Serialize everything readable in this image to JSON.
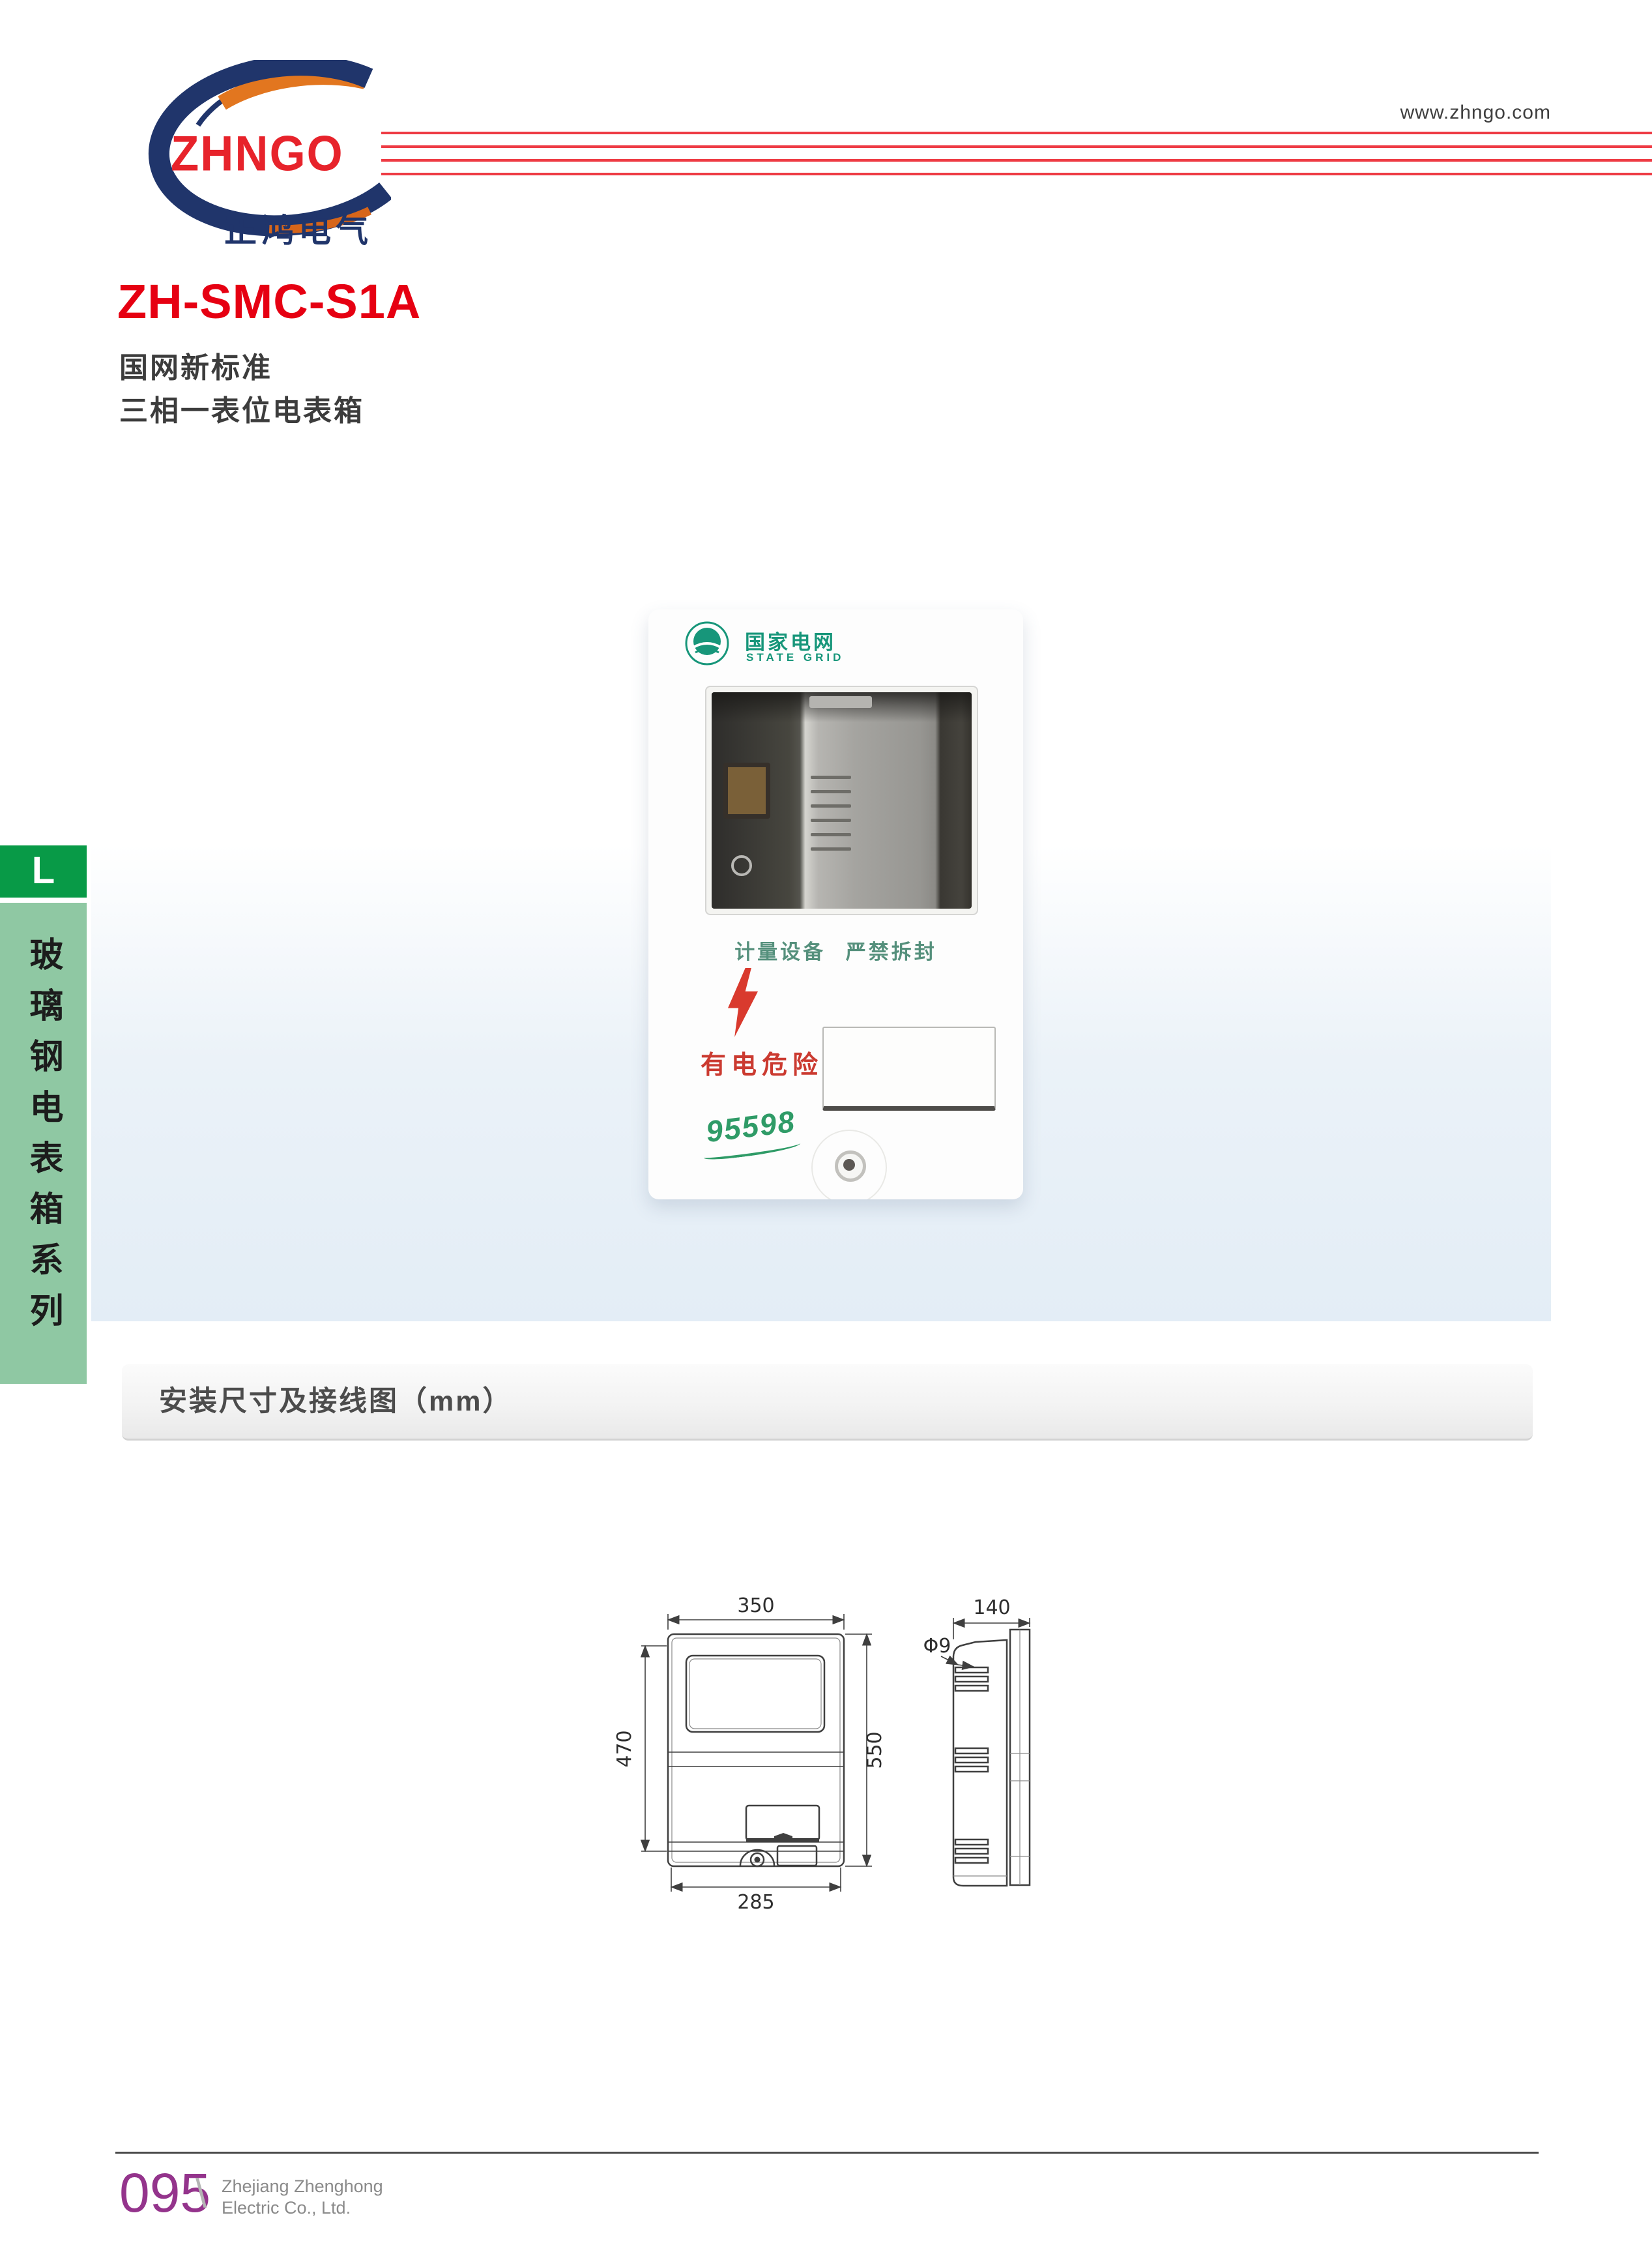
{
  "header": {
    "website": "www.zhngo.com",
    "brand": "ZHNGO",
    "brand_cn": "正鸿电气"
  },
  "product": {
    "model": "ZH-SMC-S1A",
    "standard": "国网新标准",
    "type": "三相一表位电表箱"
  },
  "sidebar": {
    "index_letter": "L",
    "series": "玻璃钢电表箱系列"
  },
  "photo": {
    "emblem_cn": "国家电网",
    "emblem_en": "STATE GRID",
    "caption": "计量设备 严禁拆封",
    "danger": "有电危险",
    "hotline": "95598"
  },
  "section": {
    "title": "安装尺寸及接线图（mm）"
  },
  "drawings": {
    "front": {
      "top": "350",
      "left": "470",
      "right": "550",
      "bottom": "285"
    },
    "side": {
      "top": "140",
      "hole": "Φ9"
    }
  },
  "footer": {
    "page": "095",
    "separator": "\\",
    "company1": "Zhejiang Zhenghong",
    "company2": "Electric Co., Ltd."
  },
  "colors": {
    "accent_red": "#e60012",
    "logo_red": "#e7232b",
    "logo_navy": "#20356b",
    "header_line_red": "#ee3b44",
    "grid_green": "#17967a",
    "sidebar_dark_green": "#089a47",
    "sidebar_light_green": "#8fc8a3",
    "page_number_purple": "#94348c"
  }
}
